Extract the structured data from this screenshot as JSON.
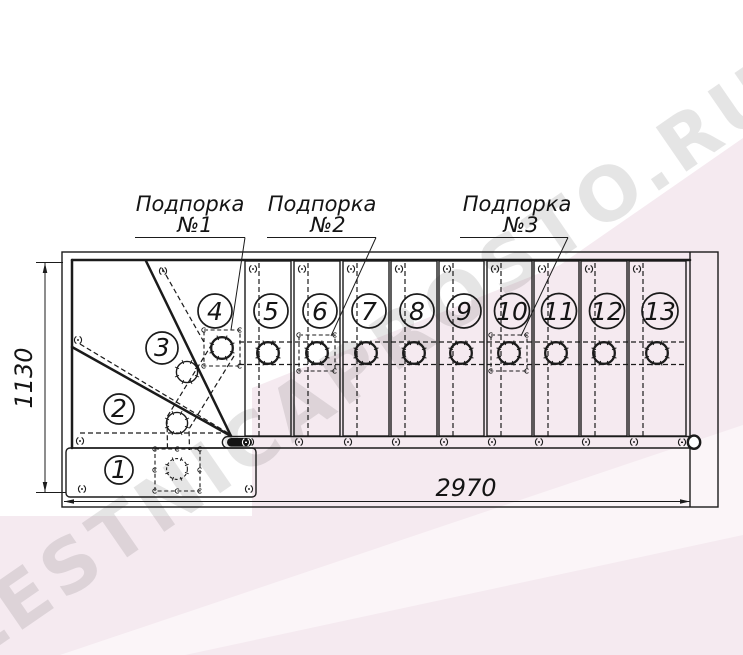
{
  "drawing": {
    "watermark": "LESTNICAPROSTO.RU",
    "supports": [
      {
        "label": "Подпорка",
        "number": "№1"
      },
      {
        "label": "Подпорка",
        "number": "№2"
      },
      {
        "label": "Подпорка",
        "number": "№3"
      }
    ],
    "dimensions": {
      "depth": "1130",
      "length": "2970"
    },
    "steps": [
      "1",
      "2",
      "3",
      "4",
      "5",
      "6",
      "7",
      "8",
      "9",
      "10",
      "11",
      "12",
      "13"
    ],
    "colors": {
      "line": "#1b1b1b",
      "background": "#ffffff",
      "pink_band": "#f5eaf0",
      "pink_light": "#fbf5f8",
      "watermark_gray": "#e2e2e2"
    }
  }
}
